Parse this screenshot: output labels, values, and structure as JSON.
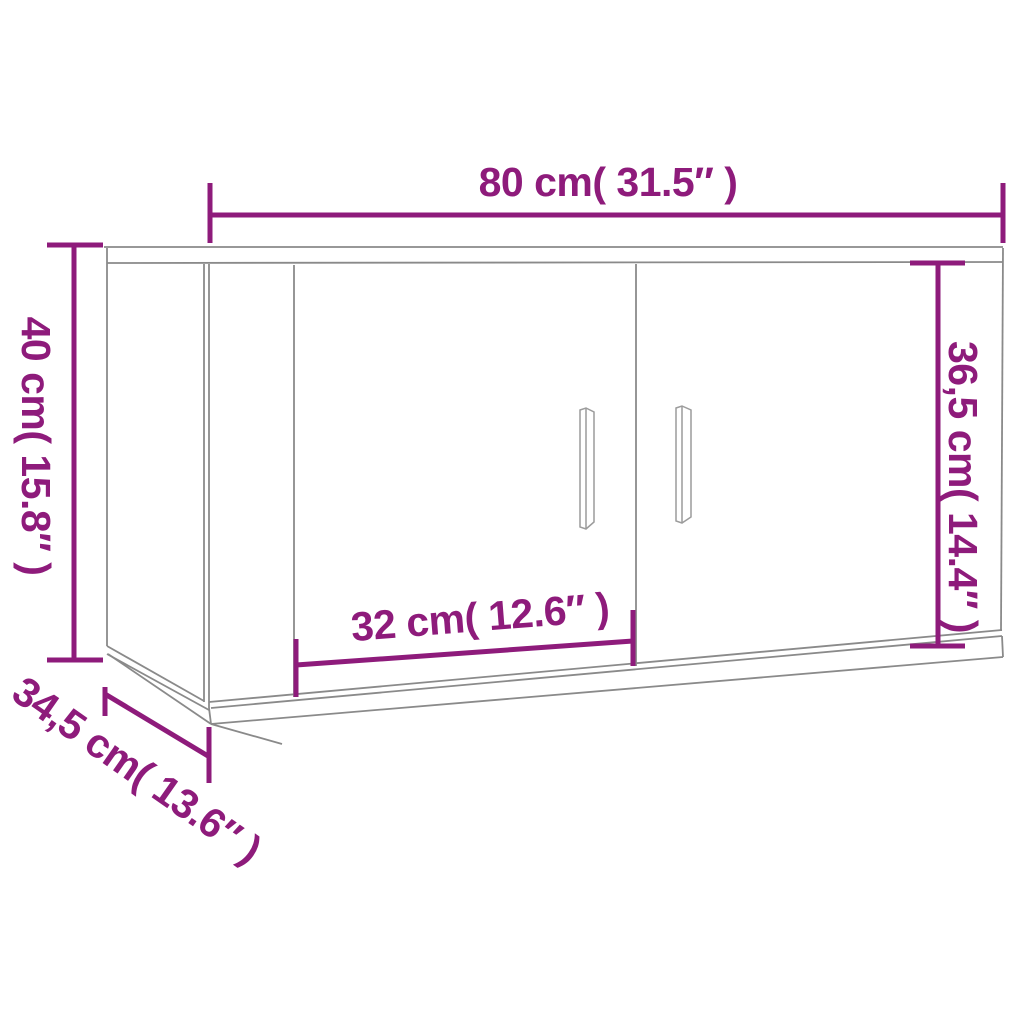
{
  "colors": {
    "dimension": "#8E1B7B",
    "line": "#8A8A8A",
    "line_light": "#9C9C9C",
    "background": "#FFFFFF"
  },
  "labels": {
    "width": "80 cm( 31.5″ )",
    "height": "40 cm( 15.8″ )",
    "door_height": "36,5 cm( 14.4″ )",
    "door_width": "32 cm( 12.6″ )",
    "depth": "34,5 cm( 13.6″ )"
  }
}
